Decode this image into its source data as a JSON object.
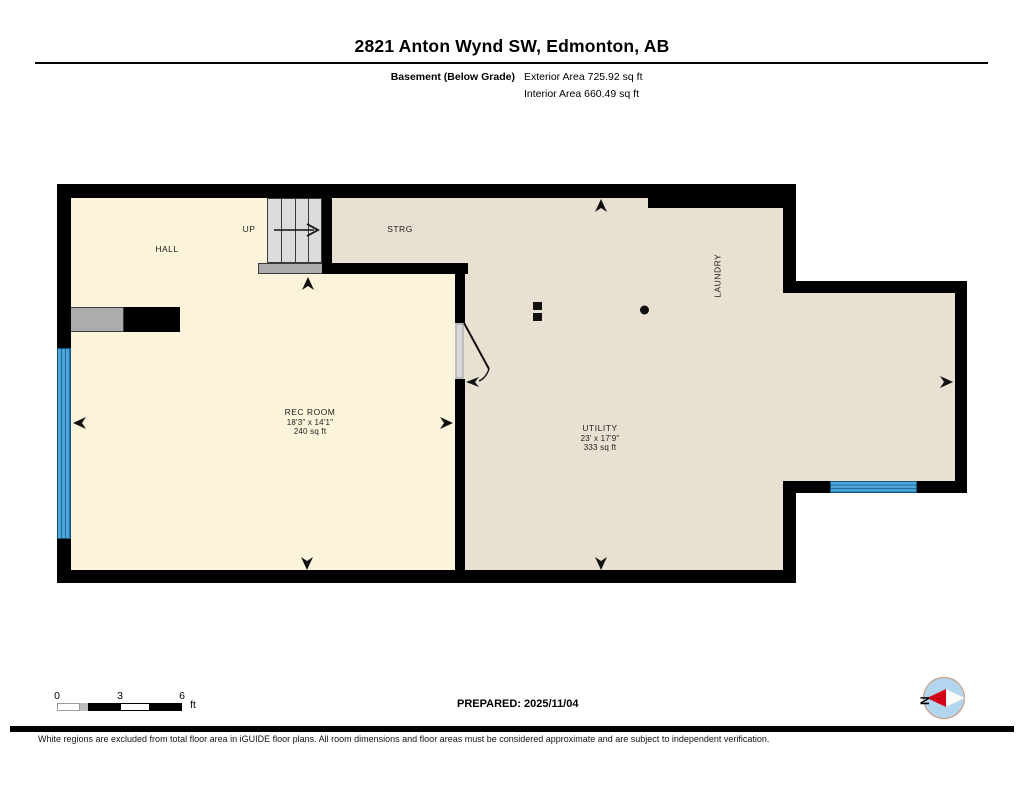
{
  "header": {
    "title": "2821 Anton Wynd SW, Edmonton, AB",
    "floor_label": "Basement (Below Grade)",
    "exterior_area": "Exterior Area 725.92 sq ft",
    "interior_area": "Interior Area 660.49 sq ft"
  },
  "rooms": {
    "hall": {
      "label": "HALL"
    },
    "stairs": {
      "up_label": "UP"
    },
    "storage": {
      "label": "STRG"
    },
    "laundry": {
      "label": "LAUNDRY"
    },
    "rec_room": {
      "label": "REC ROOM",
      "dimensions": "18'3\" x 14'1\"",
      "area": "240 sq ft"
    },
    "utility": {
      "label": "UTILITY",
      "dimensions": "23' x 17'9\"",
      "area": "333 sq ft"
    }
  },
  "footer": {
    "scale": {
      "t0": "0",
      "t1": "3",
      "t2": "6",
      "unit": "ft"
    },
    "prepared": "PREPARED: 2025/11/04",
    "compass_north": "N",
    "disclaimer": "White regions are excluded from total floor area in iGUIDE floor plans. All room dimensions and floor areas must be considered approximate and are subject to independent verification."
  },
  "colors": {
    "room_cream": "#FBF4DA",
    "room_beige": "#E8E1D2",
    "wall": "#000000",
    "window_blue": "#4EA4D6",
    "stair_gray": "#DBDBDB",
    "compass_red": "#D40018",
    "compass_blue": "#B2D6EE"
  }
}
